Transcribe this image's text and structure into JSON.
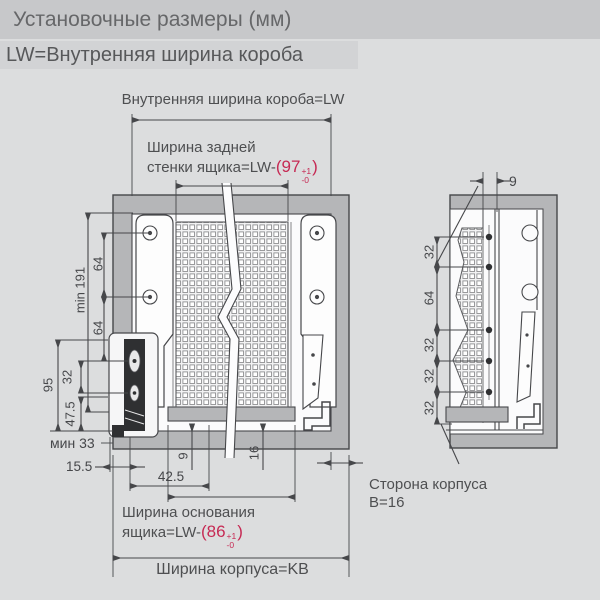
{
  "header": {
    "title": "Установочные размеры (мм)",
    "subtitle": "LW=Внутренняя ширина короба"
  },
  "colors": {
    "accent_red": "#c62a54",
    "header_bar": "#c7c8ca",
    "subheader_bar": "#d2d3d5",
    "background": "#dcddde",
    "wall_gray": "#b5b6b8",
    "line": "#46474a"
  },
  "front_view": {
    "inner_width_label": "Внутренняя ширина короба=LW",
    "back_wall_label": {
      "line1": "Ширина задней",
      "line2_prefix": "стенки ящика=LW-",
      "tolerance": {
        "open": "(97",
        "sup": "+1",
        "sub": "-0",
        "close": ")"
      }
    },
    "left_dims": {
      "min_height": "min 191",
      "hole_spacing_top": "64",
      "hole_spacing_bottom": "64",
      "slide_spacing": "32",
      "front_height": "95",
      "lower_height": "47.5"
    },
    "bottom_dims": {
      "min_clearance": "мин 33",
      "side_offset": "15.5",
      "base_offset": "42.5",
      "bottom_gap": "9",
      "profile_height": "16"
    },
    "base_width_label": {
      "line1": "Ширина основания",
      "line2_prefix": "ящика=LW-",
      "tolerance": {
        "open": "(86",
        "sup": "+1",
        "sub": "-0",
        "close": ")"
      }
    },
    "body_width_label": "Ширина корпуса=KB"
  },
  "side_view": {
    "top_offset": "9",
    "hole_dims": [
      "32",
      "64",
      "32",
      "32",
      "32"
    ],
    "caption": {
      "line1": "Сторона корпуса",
      "line2": "B=16"
    }
  }
}
